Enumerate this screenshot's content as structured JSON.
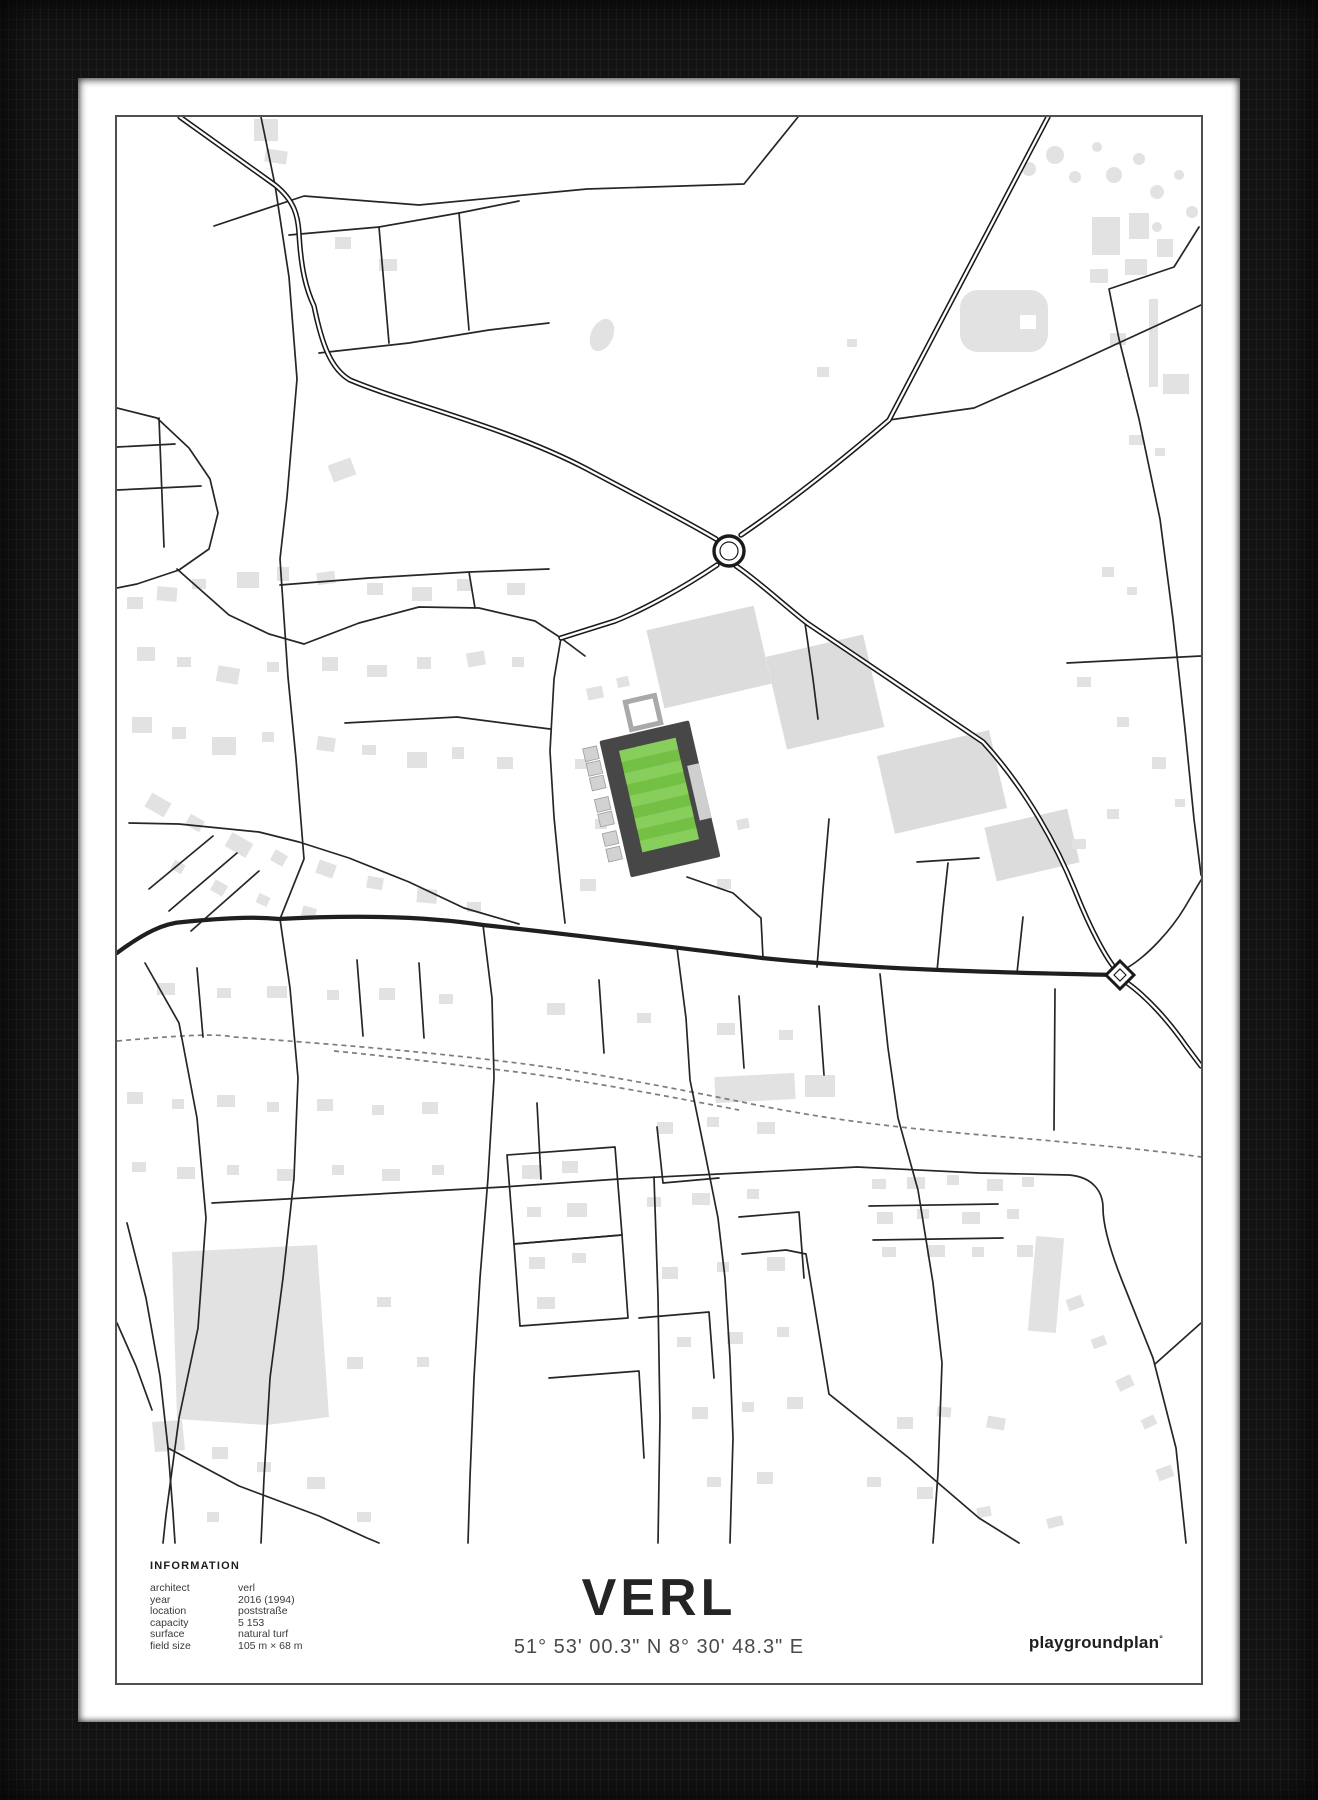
{
  "poster": {
    "frame_color": "#131313",
    "matte_color": "#ffffff",
    "border_color": "#4f4f4f"
  },
  "map": {
    "width": 1084,
    "height": 1566,
    "colors": {
      "bg": "#ffffff",
      "building": "#e2e2e2",
      "building_big": "#dcdcdc",
      "road": "#262626",
      "main": "#1f1f1f",
      "casing": "#1a1a1a",
      "rail": "#7d7d7d"
    },
    "buildings": [
      [
        137,
        2,
        24,
        22,
        0
      ],
      [
        148,
        33,
        22,
        13,
        8
      ],
      [
        218,
        120,
        16,
        12,
        0
      ],
      [
        262,
        142,
        18,
        12,
        0
      ],
      [
        213,
        344,
        24,
        18,
        -20
      ],
      [
        975,
        100,
        28,
        38,
        0
      ],
      [
        1012,
        96,
        20,
        26,
        0
      ],
      [
        1040,
        122,
        16,
        18,
        0
      ],
      [
        1008,
        142,
        22,
        16,
        0
      ],
      [
        973,
        152,
        18,
        14,
        0
      ],
      [
        1032,
        182,
        9,
        88,
        0
      ],
      [
        1046,
        257,
        26,
        20,
        0
      ],
      [
        993,
        216,
        16,
        12,
        0
      ],
      [
        1012,
        318,
        14,
        10,
        0
      ],
      [
        1038,
        331,
        10,
        8,
        0
      ],
      [
        700,
        250,
        12,
        10,
        0
      ],
      [
        730,
        222,
        10,
        8,
        0
      ],
      [
        985,
        450,
        12,
        10,
        0
      ],
      [
        1010,
        470,
        10,
        8,
        0
      ],
      [
        960,
        560,
        14,
        10,
        0
      ],
      [
        1000,
        600,
        12,
        10,
        0
      ],
      [
        1035,
        640,
        14,
        12,
        0
      ],
      [
        1058,
        682,
        10,
        8,
        0
      ],
      [
        990,
        692,
        12,
        10,
        0
      ],
      [
        955,
        722,
        14,
        10,
        0
      ],
      [
        10,
        480,
        16,
        12,
        0
      ],
      [
        40,
        470,
        20,
        14,
        5
      ],
      [
        75,
        462,
        14,
        10,
        0
      ],
      [
        120,
        455,
        22,
        16,
        0
      ],
      [
        160,
        450,
        12,
        14,
        0
      ],
      [
        200,
        455,
        18,
        12,
        -8
      ],
      [
        250,
        466,
        16,
        12,
        0
      ],
      [
        295,
        470,
        20,
        14,
        0
      ],
      [
        340,
        462,
        14,
        12,
        0
      ],
      [
        390,
        466,
        18,
        12,
        0
      ],
      [
        20,
        530,
        18,
        14,
        0
      ],
      [
        60,
        540,
        14,
        10,
        0
      ],
      [
        100,
        550,
        22,
        16,
        10
      ],
      [
        150,
        545,
        12,
        10,
        0
      ],
      [
        205,
        540,
        16,
        14,
        0
      ],
      [
        250,
        548,
        20,
        12,
        0
      ],
      [
        300,
        540,
        14,
        12,
        0
      ],
      [
        350,
        535,
        18,
        14,
        -10
      ],
      [
        395,
        540,
        12,
        10,
        0
      ],
      [
        15,
        600,
        20,
        16,
        0
      ],
      [
        55,
        610,
        14,
        12,
        0
      ],
      [
        95,
        620,
        24,
        18,
        0
      ],
      [
        145,
        615,
        12,
        10,
        0
      ],
      [
        200,
        620,
        18,
        14,
        8
      ],
      [
        245,
        628,
        14,
        10,
        0
      ],
      [
        290,
        635,
        20,
        16,
        0
      ],
      [
        335,
        630,
        12,
        12,
        0
      ],
      [
        380,
        640,
        16,
        12,
        0
      ],
      [
        30,
        680,
        22,
        16,
        30
      ],
      [
        70,
        700,
        16,
        12,
        30
      ],
      [
        110,
        720,
        24,
        16,
        30
      ],
      [
        155,
        735,
        14,
        12,
        30
      ],
      [
        200,
        745,
        18,
        14,
        20
      ],
      [
        250,
        760,
        16,
        12,
        10
      ],
      [
        300,
        772,
        20,
        14,
        5
      ],
      [
        350,
        785,
        14,
        10,
        0
      ],
      [
        55,
        745,
        12,
        10,
        30
      ],
      [
        95,
        765,
        14,
        12,
        30
      ],
      [
        140,
        778,
        12,
        10,
        25
      ],
      [
        185,
        790,
        14,
        10,
        15
      ],
      [
        470,
        570,
        16,
        12,
        -12
      ],
      [
        500,
        560,
        12,
        10,
        -12
      ],
      [
        458,
        642,
        14,
        10,
        0
      ],
      [
        478,
        702,
        12,
        10,
        0
      ],
      [
        463,
        762,
        16,
        12,
        0
      ],
      [
        600,
        762,
        14,
        10,
        0
      ],
      [
        620,
        702,
        12,
        10,
        -12
      ],
      [
        40,
        866,
        18,
        12,
        0
      ],
      [
        100,
        871,
        14,
        10,
        0
      ],
      [
        150,
        869,
        20,
        12,
        0
      ],
      [
        210,
        873,
        12,
        10,
        0
      ],
      [
        262,
        871,
        16,
        12,
        0
      ],
      [
        322,
        877,
        14,
        10,
        0
      ],
      [
        430,
        886,
        18,
        12,
        0
      ],
      [
        520,
        896,
        14,
        10,
        0
      ],
      [
        600,
        906,
        18,
        12,
        0
      ],
      [
        662,
        913,
        14,
        10,
        0
      ],
      [
        598,
        958,
        80,
        26,
        -3
      ],
      [
        688,
        958,
        30,
        22,
        0
      ],
      [
        10,
        975,
        16,
        12,
        0
      ],
      [
        55,
        982,
        12,
        10,
        0
      ],
      [
        100,
        978,
        18,
        12,
        0
      ],
      [
        150,
        985,
        12,
        10,
        0
      ],
      [
        200,
        982,
        16,
        12,
        0
      ],
      [
        255,
        988,
        12,
        10,
        0
      ],
      [
        305,
        985,
        16,
        12,
        0
      ],
      [
        15,
        1045,
        14,
        10,
        0
      ],
      [
        60,
        1050,
        18,
        12,
        0
      ],
      [
        110,
        1048,
        12,
        10,
        0
      ],
      [
        160,
        1052,
        16,
        12,
        0
      ],
      [
        215,
        1048,
        12,
        10,
        0
      ],
      [
        265,
        1052,
        18,
        12,
        0
      ],
      [
        315,
        1048,
        12,
        10,
        0
      ],
      [
        405,
        1048,
        20,
        14,
        0
      ],
      [
        445,
        1044,
        16,
        12,
        0
      ],
      [
        410,
        1090,
        14,
        10,
        0
      ],
      [
        450,
        1086,
        20,
        14,
        0
      ],
      [
        412,
        1140,
        16,
        12,
        0
      ],
      [
        455,
        1136,
        14,
        10,
        0
      ],
      [
        420,
        1180,
        18,
        12,
        0
      ],
      [
        540,
        1005,
        16,
        12,
        0
      ],
      [
        590,
        1000,
        12,
        10,
        0
      ],
      [
        640,
        1005,
        18,
        12,
        0
      ],
      [
        530,
        1080,
        14,
        10,
        0
      ],
      [
        575,
        1076,
        18,
        12,
        0
      ],
      [
        630,
        1072,
        12,
        10,
        0
      ],
      [
        545,
        1150,
        16,
        12,
        0
      ],
      [
        600,
        1145,
        12,
        10,
        0
      ],
      [
        650,
        1140,
        18,
        14,
        0
      ],
      [
        560,
        1220,
        14,
        10,
        0
      ],
      [
        610,
        1215,
        16,
        12,
        0
      ],
      [
        660,
        1210,
        12,
        10,
        0
      ],
      [
        575,
        1290,
        16,
        12,
        0
      ],
      [
        625,
        1285,
        12,
        10,
        0
      ],
      [
        670,
        1280,
        16,
        12,
        0
      ],
      [
        590,
        1360,
        14,
        10,
        0
      ],
      [
        640,
        1355,
        16,
        12,
        0
      ],
      [
        755,
        1062,
        14,
        10,
        0
      ],
      [
        790,
        1060,
        18,
        12,
        0
      ],
      [
        830,
        1058,
        12,
        10,
        0
      ],
      [
        870,
        1062,
        16,
        12,
        0
      ],
      [
        905,
        1060,
        12,
        10,
        0
      ],
      [
        760,
        1095,
        16,
        12,
        0
      ],
      [
        800,
        1092,
        12,
        10,
        0
      ],
      [
        845,
        1095,
        18,
        12,
        0
      ],
      [
        890,
        1092,
        12,
        10,
        0
      ],
      [
        765,
        1130,
        14,
        10,
        0
      ],
      [
        810,
        1128,
        18,
        12,
        0
      ],
      [
        855,
        1130,
        12,
        10,
        0
      ],
      [
        900,
        1128,
        16,
        12,
        0
      ],
      [
        915,
        1120,
        28,
        95,
        5
      ],
      [
        950,
        1180,
        16,
        12,
        -20
      ],
      [
        975,
        1220,
        14,
        10,
        -20
      ],
      [
        1000,
        1260,
        16,
        12,
        -25
      ],
      [
        1025,
        1300,
        14,
        10,
        -25
      ],
      [
        1040,
        1350,
        16,
        12,
        -20
      ],
      [
        870,
        1300,
        18,
        12,
        10
      ],
      [
        820,
        1290,
        14,
        10,
        5
      ],
      [
        780,
        1300,
        16,
        12,
        0
      ],
      [
        750,
        1360,
        14,
        10,
        0
      ],
      [
        800,
        1370,
        16,
        12,
        0
      ],
      [
        860,
        1390,
        14,
        10,
        -10
      ],
      [
        930,
        1400,
        16,
        10,
        -15
      ],
      [
        95,
        1330,
        16,
        12,
        0
      ],
      [
        140,
        1345,
        14,
        10,
        0
      ],
      [
        190,
        1360,
        18,
        12,
        0
      ],
      [
        240,
        1395,
        14,
        10,
        0
      ],
      [
        90,
        1395,
        12,
        10,
        0
      ],
      [
        230,
        1240,
        16,
        12,
        0
      ],
      [
        260,
        1180,
        14,
        10,
        0
      ],
      [
        300,
        1240,
        12,
        10,
        0
      ]
    ],
    "big_buildings": [
      [
        592,
        540,
        110,
        80,
        -13
      ],
      [
        708,
        575,
        100,
        95,
        -13
      ],
      [
        825,
        665,
        115,
        80,
        -13
      ],
      [
        915,
        728,
        85,
        55,
        -13
      ]
    ],
    "tree_circles": [
      [
        912,
        52,
        7
      ],
      [
        938,
        38,
        9
      ],
      [
        958,
        60,
        6
      ],
      [
        980,
        30,
        5
      ],
      [
        997,
        58,
        8
      ],
      [
        1022,
        42,
        6
      ],
      [
        1040,
        75,
        7
      ],
      [
        1062,
        58,
        5
      ],
      [
        1075,
        95,
        6
      ],
      [
        1040,
        110,
        5
      ]
    ],
    "polygons": [
      "55,1135 200,1128 212,1300 150,1308 60,1302",
      "35,1305 65,1303 68,1333 38,1335"
    ],
    "blob": {
      "x": 843,
      "y": 173,
      "w": 88,
      "h": 62,
      "rx": 18,
      "notch": [
        903,
        198,
        16,
        14
      ]
    },
    "pond": {
      "cx": 485,
      "cy": 218,
      "rx": 11,
      "ry": 17,
      "rot": 25
    },
    "minor_roads": [
      "M144,0 L158,68 L172,160 L180,262 L170,380 L163,442 L171,560 L179,642 L187,742 L163,802",
      "M97,109 L187,79 L302,88 L470,72 L627,67 L681,0",
      "M1082,110 L1057,150 L992,172 L1002,222 L1022,302 L1043,402 L1056,502 L1068,612 L1077,702 L1084,758",
      "M772,303 L857,291 L941,254 L1056,201 L1084,188",
      "M444,521 L437,562 L433,634 L437,700 L443,762 L448,806",
      "M228,606 L340,600 L433,612",
      "M187,527 L242,506 L302,490 L362,491 L418,504 L444,521",
      "M60,452 L112,498 L152,517 L187,527",
      "M0,291 L40,301 L72,331 L93,362 L101,396 L92,432 L62,453 L20,467 L0,471",
      "M0,330 L58,327",
      "M0,373 L84,369",
      "M42,301 L47,430",
      "M12,706 L62,707 L142,715 L182,725 L232,741 L292,765 L347,791 L402,807",
      "M32,772 L96,719",
      "M52,794 L120,736",
      "M74,814 L142,754",
      "M172,118 L262,110 L342,96 L402,84",
      "M262,110 L272,226",
      "M342,96 L352,213",
      "M202,236 L292,226 L372,213 L432,206",
      "M163,468 L252,461 L352,455 L432,452",
      "M352,455 L358,491",
      "M444,521 L468,539",
      "M688,506 L696,562 L701,602",
      "M570,760 L616,776 L644,801 L646,841",
      "M700,850 L706,772 L712,702",
      "M820,854 L826,792 L831,746",
      "M800,745 L862,741",
      "M900,856 L906,800",
      "M950,546 L1084,539",
      "M938,872 L937,1013",
      "M80,851 L86,920",
      "M240,843 L246,919",
      "M302,846 L307,921",
      "M482,863 L487,936",
      "M622,879 L627,951",
      "M702,889 L707,958",
      "M95,1086 L242,1078 L386,1070 L502,1062 L622,1056 L740,1050",
      "M390,1038 L498,1030 L505,1118 L397,1127 Z",
      "M397,1127 L505,1118 L511,1201 L403,1209 Z",
      "M540,1010 L546,1066 L602,1061",
      "M622,1100 L682,1095 L687,1161",
      "M522,1201 L592,1195 L597,1261",
      "M432,1261 L522,1254 L527,1341",
      "M537,1060 L541,1180 L543,1301 L541,1426",
      "M420,986 L424,1062",
      "M28,846 L62,906 L80,1001 L89,1101 L81,1211 L62,1301 L49,1398 L46,1426",
      "M163,802 L173,871 L181,961 L177,1061 L166,1161 L153,1261 L147,1361 L144,1426",
      "M366,808 L375,881 L377,961 L371,1061 L363,1161 L357,1261 L353,1361 L351,1426",
      "M560,831 L569,901 L573,963 L589,1041 L601,1101 L608,1161 L613,1241 L616,1321 L613,1426",
      "M763,857 L771,931 L781,1001 L801,1073 L816,1166 L825,1246 L821,1356 L816,1426",
      "M740,1050 L862,1056 L952,1058 C977,1060 986,1076 986,1091 C986,1111 996,1141 1006,1166 L1036,1241 L1059,1331 L1069,1426",
      "M752,1089 L881,1087",
      "M756,1123 L886,1121",
      "M712,1277 L792,1341 L862,1401 L902,1426",
      "M625,1137 L669,1133 L689,1137 L712,1277",
      "M1084,1206 L1038,1247",
      "M10,1106 L29,1181 L43,1259 L51,1331 L56,1396 L58,1426",
      "M0,1206 L19,1249 L35,1293",
      "M51,1331 L122,1369 L202,1399 L250,1421 L262,1426",
      "M1008,852 C1030,840 1055,812 1068,790 L1084,763"
    ],
    "railways": [
      "M0,924 C80,917 100,917 117,920 C230,928 320,936 400,946 C480,956 560,972 625,985 C720,1005 800,1013 925,1023 C1000,1030 1050,1035 1084,1040",
      "M217,934 C280,940 340,948 400,955 C470,964 550,979 622,993"
    ],
    "main_roads": [
      "M0,836 C28,815 48,806 66,805 C118,800 140,800 162,802 C255,797 320,801 366,808 C470,819 560,831 645,841 C760,853 900,856 1003,858"
    ],
    "highways": [
      "M63,0 L158,68 C178,84 181,100 182,116 C184,152 189,172 197,189 C205,228 214,252 233,263 C290,287 390,310 470,352 C515,376 567,403 599,422",
      "M624,418 C665,390 716,351 772,303 L931,0",
      "M619,449 C640,463 668,489 690,506 L866,625 C910,673 941,731 959,776 C973,811 989,842 1001,855",
      "M600,448 C566,471 526,493 498,504 L444,521",
      "M1006,863 C1030,879 1053,906 1069,929 L1084,949"
    ],
    "roundabout": {
      "cx": 612,
      "cy": 434,
      "r": 15
    },
    "junction": {
      "cx": 1003,
      "cy": 858,
      "r": 14
    },
    "stadium": {
      "cx": 542,
      "cy": 678,
      "rot": -13,
      "stand": {
        "x": -46,
        "y": -66,
        "w": 92,
        "h": 140,
        "color": "#474747"
      },
      "pitch": {
        "x": -29,
        "y": -52,
        "w": 58,
        "h": 104,
        "color": "#74c044",
        "stripe": "#88ce5c",
        "stripes": 9
      },
      "entrance": {
        "x": -12,
        "y": -98,
        "w": 30,
        "h": 28,
        "stroke": "#a9a9a9"
      },
      "annexes": {
        "color": "#d2d2d2",
        "x": -64,
        "w": 14,
        "h": 13,
        "ys": [
          -62,
          -47,
          -32,
          -10,
          5,
          25,
          41
        ]
      },
      "east": {
        "x": 34,
        "y": -22,
        "w": 12,
        "h": 56,
        "color": "#cfcfcf"
      }
    }
  },
  "footer": {
    "info_title": "INFORMATION",
    "info_rows": [
      {
        "label": "architect",
        "value": "verl"
      },
      {
        "label": "year",
        "value": "2016 (1994)"
      },
      {
        "label": "location",
        "value": "poststraße"
      },
      {
        "label": "capacity",
        "value": "5 153"
      },
      {
        "label": "surface",
        "value": "natural turf"
      },
      {
        "label": "field size",
        "value": "105 m × 68 m"
      }
    ],
    "title": "VERL",
    "coordinates": "51° 53' 00.3\" N 8° 30' 48.3\" E",
    "brand": "playgroundplan",
    "brand_mark": "°"
  }
}
